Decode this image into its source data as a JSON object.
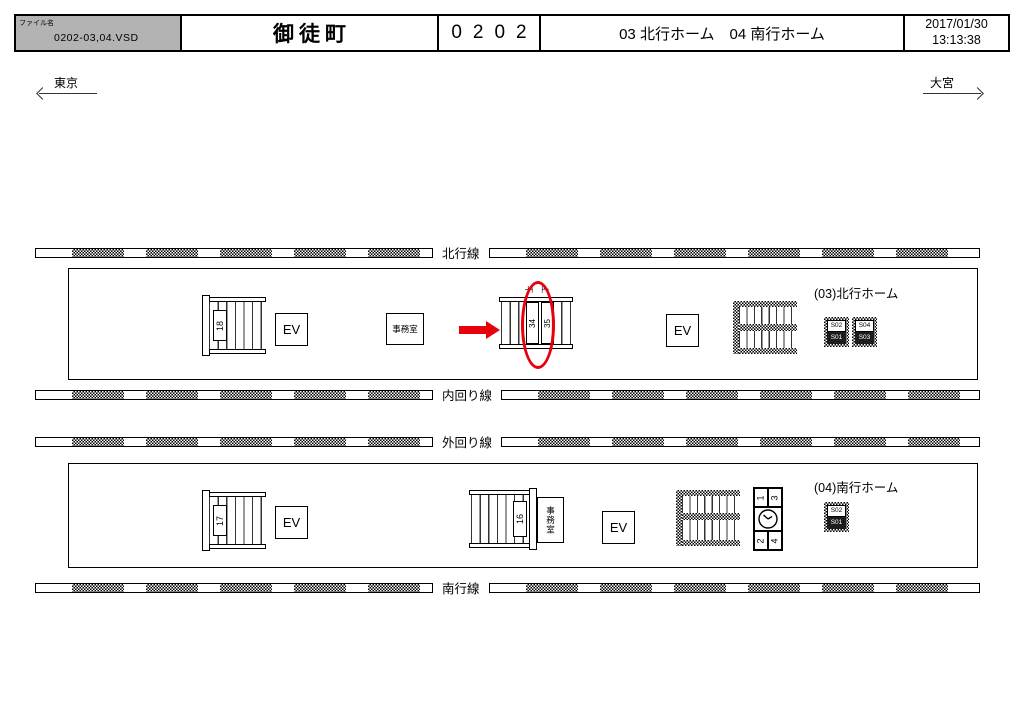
{
  "header": {
    "file_label": "ファイル名",
    "file_name": "0202-03,04.VSD",
    "station_name": "御徒町",
    "station_code": "0202",
    "platform_info": "03 北行ホーム　04 南行ホーム",
    "date": "2017/01/30",
    "time": "13:13:38"
  },
  "directions": {
    "left": "東京",
    "right": "大宮"
  },
  "tracks": [
    {
      "label": "北行線"
    },
    {
      "label": "内回り線"
    },
    {
      "label": "外回り線"
    },
    {
      "label": "南行線"
    }
  ],
  "north": {
    "label": "(03)北行ホーム",
    "stair_no": "18",
    "ev1": "EV",
    "ev2": "EV",
    "office": "事務室",
    "escalator": {
      "dir_left": "上",
      "dir_right": "下",
      "left_no": "34",
      "right_no": "35"
    },
    "badges": [
      {
        "top": "S02",
        "bottom": "S01"
      },
      {
        "top": "S04",
        "bottom": "S03"
      }
    ]
  },
  "south": {
    "label": "(04)南行ホーム",
    "stair_no": "17",
    "stair_mid_no": "16",
    "office": "事務室",
    "ev1": "EV",
    "ev2": "EV",
    "monitor": {
      "tl": "1",
      "tr": "3",
      "bl": "2",
      "br": "4"
    },
    "badges": [
      {
        "top": "S02",
        "bottom": "S01"
      }
    ]
  },
  "colors": {
    "annotation_red": "#e8000d",
    "file_cell_bg": "#b3b3b3"
  }
}
